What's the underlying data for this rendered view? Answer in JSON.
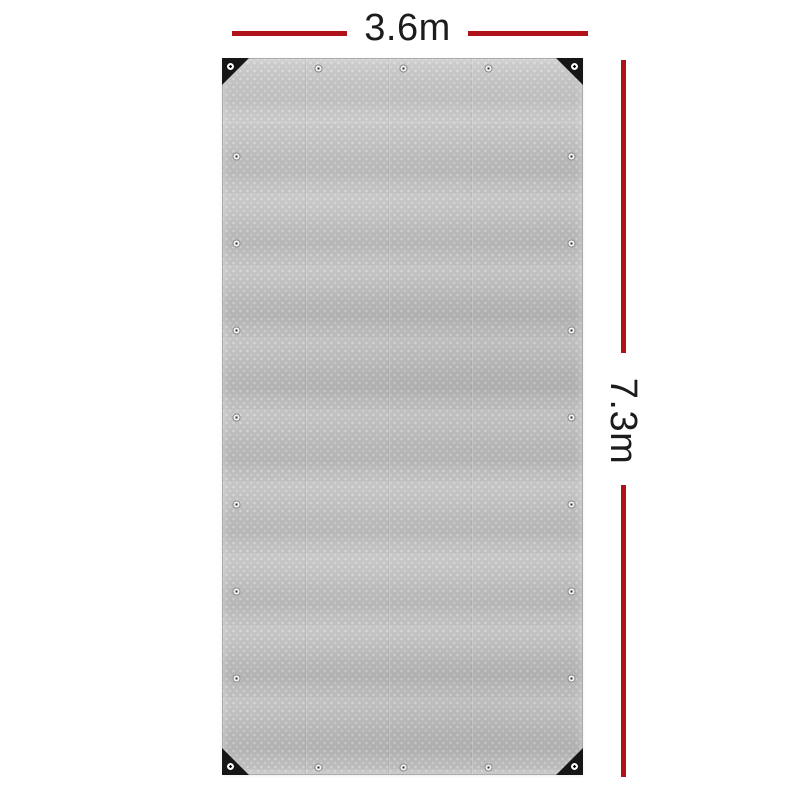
{
  "diagram": {
    "background_color": "#ffffff",
    "accent_color": "#b01219",
    "text_color": "#1c1c1c",
    "width_dimension": {
      "label": "3.6m"
    },
    "height_dimension": {
      "label": "7.3m"
    },
    "tarp": {
      "base_color": "#bdbdbd",
      "corner_patch_color": "#161616",
      "grommets": {
        "top_edge": 5,
        "bottom_edge": 5,
        "left_edge": 9,
        "right_edge": 9
      }
    }
  }
}
